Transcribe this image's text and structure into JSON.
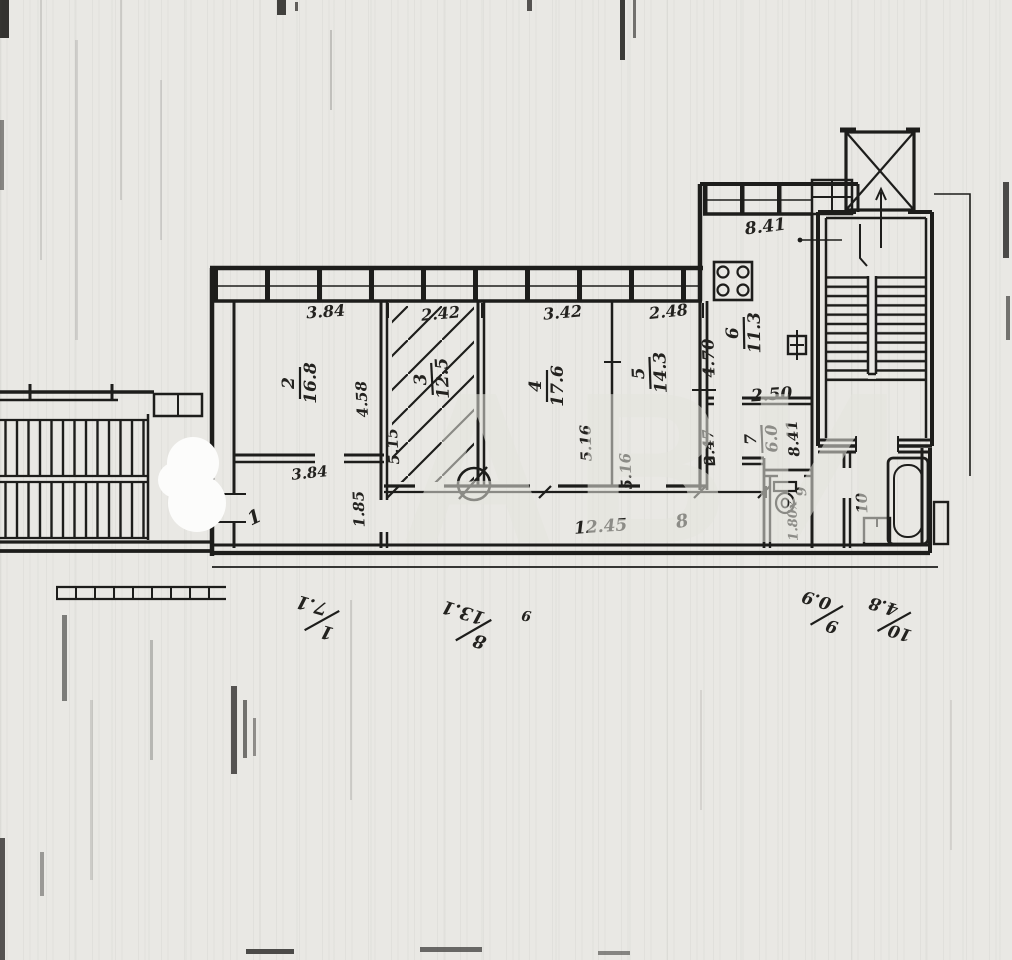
{
  "document": {
    "type": "scanned apartment floor plan",
    "watermark": "АВИ"
  },
  "colors": {
    "paper": "#e9e8e4",
    "ink": "#1d1d1b"
  },
  "rooms": [
    {
      "number": "1",
      "width": "3.84"
    },
    {
      "number": "2",
      "area": "16.8",
      "width": "3.84",
      "depth": "4.58"
    },
    {
      "number": "3",
      "area": "12.5",
      "width": "2.42",
      "depth": "5.15"
    },
    {
      "number": "4",
      "area": "17.6",
      "width": "3.42",
      "depth": "5.16"
    },
    {
      "number": "5",
      "area": "14.3",
      "width": "2.48",
      "depth": "5.16"
    },
    {
      "number": "6",
      "area": "11.3",
      "depth": "4.70",
      "note": "8.41"
    },
    {
      "number": "7",
      "area": "6.0",
      "width": "2.50",
      "depth": "2.47",
      "note": "8.41"
    },
    {
      "number": "8",
      "length": "12.45",
      "width": "1.85"
    },
    {
      "number": "9",
      "dim": "1.80х"
    },
    {
      "number": "10"
    }
  ],
  "footer_notes": [
    {
      "number": "1",
      "area": "7.1"
    },
    {
      "number": "8",
      "area": "13.1"
    },
    {
      "number": "9",
      "area": "0.9"
    },
    {
      "number": "10",
      "area": "4.8"
    }
  ],
  "stray_mark": "9"
}
